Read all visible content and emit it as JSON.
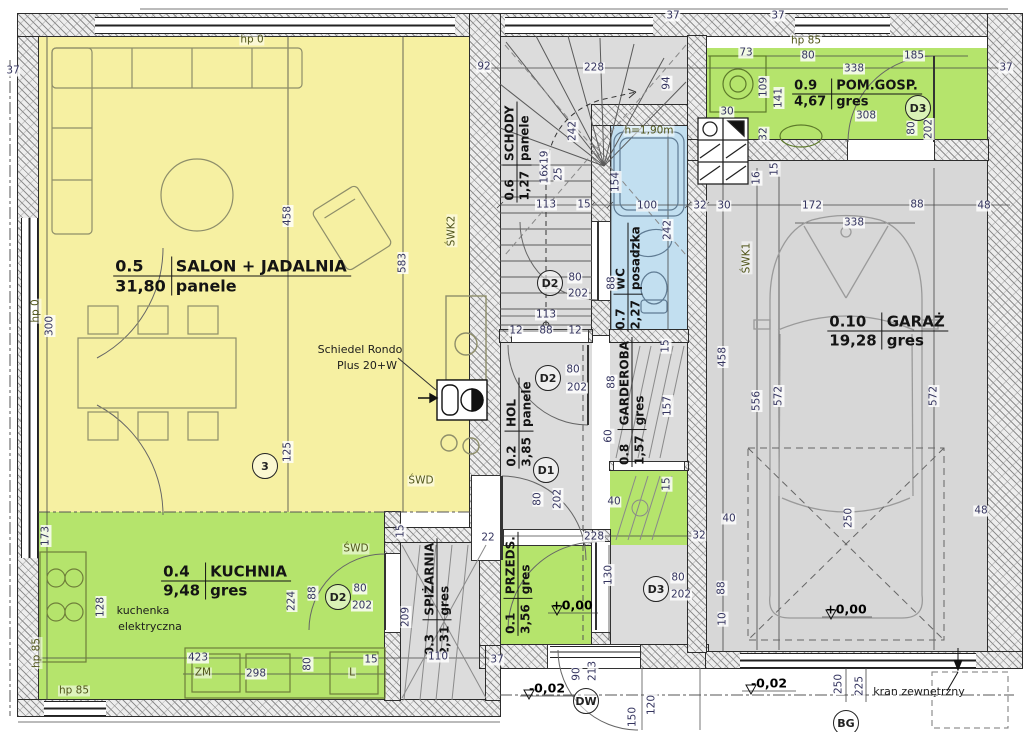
{
  "plan": {
    "rooms": [
      {
        "id": "0.1",
        "name": "PRZEDS.",
        "area": "3,56",
        "floor": "gres"
      },
      {
        "id": "0.2",
        "name": "HOL",
        "area": "3,85",
        "floor": "panele"
      },
      {
        "id": "0.3",
        "name": "SPIŻARNIA",
        "area": "2,31",
        "floor": "gres"
      },
      {
        "id": "0.4",
        "name": "KUCHNIA",
        "area": "9,48",
        "floor": "gres"
      },
      {
        "id": "0.5",
        "name": "SALON + JADALNIA",
        "area": "31,80",
        "floor": "panele"
      },
      {
        "id": "0.6",
        "name": "SCHODY",
        "area": "1,27",
        "floor": "panele"
      },
      {
        "id": "0.7",
        "name": "WC",
        "area": "2,27",
        "floor": "posadzka"
      },
      {
        "id": "0.8",
        "name": "GARDEROBA",
        "area": "1,57",
        "floor": "gres"
      },
      {
        "id": "0.9",
        "name": "POM.GOSP.",
        "area": "4,67",
        "floor": "gres"
      },
      {
        "id": "0.10",
        "name": "GARAŻ",
        "area": "19,28",
        "floor": "gres"
      }
    ],
    "colors": {
      "salon": "#f6f0a2",
      "kitchen": "#b5e46c",
      "wc": "#c2dff0",
      "gray": "#dcdcdc",
      "garage": "#d7d7d7"
    },
    "door_tags": [
      {
        "t": "D2",
        "x": 338,
        "y": 597
      },
      {
        "t": "D2",
        "x": 550,
        "y": 283
      },
      {
        "t": "D2",
        "x": 548,
        "y": 378
      },
      {
        "t": "D1",
        "x": 546,
        "y": 470
      },
      {
        "t": "D3",
        "x": 656,
        "y": 589
      },
      {
        "t": "D3",
        "x": 918,
        "y": 108
      },
      {
        "t": "DW",
        "x": 586,
        "y": 701
      },
      {
        "t": "BG",
        "x": 846,
        "y": 723
      },
      {
        "t": "3",
        "x": 265,
        "y": 466
      }
    ],
    "labels": [
      {
        "t": "37",
        "x": 13,
        "y": 71
      },
      {
        "t": "hp 0",
        "x": 252,
        "y": 40,
        "k": "ann"
      },
      {
        "t": "92",
        "x": 484,
        "y": 67
      },
      {
        "t": "228",
        "x": 594,
        "y": 68
      },
      {
        "t": "94",
        "x": 667,
        "y": 83,
        "r": 1
      },
      {
        "t": "37",
        "x": 673,
        "y": 16
      },
      {
        "t": "37",
        "x": 778,
        "y": 16
      },
      {
        "t": "73",
        "x": 746,
        "y": 53
      },
      {
        "t": "hp 85",
        "x": 806,
        "y": 41,
        "k": "ann"
      },
      {
        "t": "80",
        "x": 808,
        "y": 56
      },
      {
        "t": "185",
        "x": 914,
        "y": 56
      },
      {
        "t": "338",
        "x": 854,
        "y": 69
      },
      {
        "t": "109",
        "x": 764,
        "y": 87,
        "r": 1
      },
      {
        "t": "141",
        "x": 779,
        "y": 98,
        "r": 1
      },
      {
        "t": "308",
        "x": 866,
        "y": 116
      },
      {
        "t": "30",
        "x": 727,
        "y": 112
      },
      {
        "t": "32",
        "x": 764,
        "y": 134,
        "r": 1
      },
      {
        "t": "37",
        "x": 1006,
        "y": 68
      },
      {
        "t": "80",
        "x": 912,
        "y": 128,
        "r": 1
      },
      {
        "t": "202",
        "x": 929,
        "y": 129,
        "r": 1
      },
      {
        "t": "h=1,90m",
        "x": 649,
        "y": 131,
        "k": "ann"
      },
      {
        "t": "113",
        "x": 546,
        "y": 205
      },
      {
        "t": "15",
        "x": 584,
        "y": 205
      },
      {
        "t": "100",
        "x": 647,
        "y": 206
      },
      {
        "t": "32",
        "x": 700,
        "y": 206
      },
      {
        "t": "30",
        "x": 724,
        "y": 206
      },
      {
        "t": "172",
        "x": 812,
        "y": 206
      },
      {
        "t": "88",
        "x": 917,
        "y": 205
      },
      {
        "t": "48",
        "x": 984,
        "y": 206
      },
      {
        "t": "338",
        "x": 854,
        "y": 223
      },
      {
        "t": "16",
        "x": 757,
        "y": 178,
        "r": 1
      },
      {
        "t": "15",
        "x": 775,
        "y": 169,
        "r": 1
      },
      {
        "t": "ŚWK1",
        "x": 747,
        "y": 258,
        "r": 1,
        "k": "ann"
      },
      {
        "t": "242",
        "x": 668,
        "y": 230,
        "r": 1
      },
      {
        "t": "154",
        "x": 616,
        "y": 182,
        "r": 1
      },
      {
        "t": "88",
        "x": 612,
        "y": 283,
        "r": 1
      },
      {
        "t": "16x19",
        "x": 545,
        "y": 167,
        "r": 1
      },
      {
        "t": "25",
        "x": 559,
        "y": 174,
        "r": 1
      },
      {
        "t": "242",
        "x": 573,
        "y": 131,
        "r": 1
      },
      {
        "t": "583",
        "x": 403,
        "y": 263,
        "r": 1
      },
      {
        "t": "458",
        "x": 288,
        "y": 216,
        "r": 1
      },
      {
        "t": "125",
        "x": 288,
        "y": 452,
        "r": 1
      },
      {
        "t": "hp 0",
        "x": 36,
        "y": 311,
        "r": 1,
        "k": "ann"
      },
      {
        "t": "300",
        "x": 50,
        "y": 326,
        "r": 1
      },
      {
        "t": "173",
        "x": 46,
        "y": 536,
        "r": 1
      },
      {
        "t": "128",
        "x": 101,
        "y": 607,
        "r": 1
      },
      {
        "t": "ŚWK2",
        "x": 452,
        "y": 231,
        "r": 1,
        "k": "ann"
      },
      {
        "t": "ŚWD",
        "x": 421,
        "y": 481,
        "k": "ann"
      },
      {
        "t": "ŚWD",
        "x": 356,
        "y": 549,
        "k": "ann"
      },
      {
        "t": "Schiedel Rondo",
        "x": 360,
        "y": 350,
        "k": "note"
      },
      {
        "t": "Plus 20+W",
        "x": 367,
        "y": 366,
        "k": "note"
      },
      {
        "t": "kuchenka",
        "x": 143,
        "y": 611,
        "k": "note"
      },
      {
        "t": "elektryczna",
        "x": 150,
        "y": 627,
        "k": "note"
      },
      {
        "t": "224",
        "x": 292,
        "y": 601,
        "r": 1
      },
      {
        "t": "88",
        "x": 313,
        "y": 593,
        "r": 1
      },
      {
        "t": "80",
        "x": 360,
        "y": 589
      },
      {
        "t": "202",
        "x": 362,
        "y": 606
      },
      {
        "t": "209",
        "x": 406,
        "y": 617,
        "r": 1
      },
      {
        "t": "15",
        "x": 401,
        "y": 531,
        "r": 1
      },
      {
        "t": "22",
        "x": 488,
        "y": 538
      },
      {
        "t": "110",
        "x": 438,
        "y": 657
      },
      {
        "t": "37",
        "x": 497,
        "y": 660
      },
      {
        "t": "423",
        "x": 198,
        "y": 658
      },
      {
        "t": "ZM",
        "x": 203,
        "y": 673,
        "k": "ann"
      },
      {
        "t": "298",
        "x": 256,
        "y": 674
      },
      {
        "t": "80",
        "x": 308,
        "y": 664,
        "r": 1
      },
      {
        "t": "L",
        "x": 352,
        "y": 673,
        "k": "ann"
      },
      {
        "t": "15",
        "x": 371,
        "y": 660
      },
      {
        "t": "hp 85",
        "x": 74,
        "y": 691,
        "k": "ann"
      },
      {
        "t": "hp 85",
        "x": 37,
        "y": 653,
        "r": 1,
        "k": "ann"
      },
      {
        "t": "12",
        "x": 516,
        "y": 331
      },
      {
        "t": "88",
        "x": 546,
        "y": 331
      },
      {
        "t": "12",
        "x": 575,
        "y": 331
      },
      {
        "t": "113",
        "x": 546,
        "y": 315
      },
      {
        "t": "80",
        "x": 575,
        "y": 278
      },
      {
        "t": "202",
        "x": 578,
        "y": 294
      },
      {
        "t": "80",
        "x": 573,
        "y": 370
      },
      {
        "t": "202",
        "x": 577,
        "y": 388
      },
      {
        "t": "80",
        "x": 538,
        "y": 499,
        "r": 1
      },
      {
        "t": "202",
        "x": 558,
        "y": 499,
        "r": 1
      },
      {
        "t": "60",
        "x": 609,
        "y": 436,
        "r": 1
      },
      {
        "t": "88",
        "x": 612,
        "y": 382,
        "r": 1
      },
      {
        "t": "15",
        "x": 666,
        "y": 346,
        "r": 1
      },
      {
        "t": "157",
        "x": 668,
        "y": 406,
        "r": 1
      },
      {
        "t": "458",
        "x": 723,
        "y": 357,
        "r": 1
      },
      {
        "t": "15",
        "x": 667,
        "y": 484,
        "r": 1
      },
      {
        "t": "40",
        "x": 614,
        "y": 502
      },
      {
        "t": "40",
        "x": 729,
        "y": 519
      },
      {
        "t": "32",
        "x": 699,
        "y": 536
      },
      {
        "t": "228",
        "x": 594,
        "y": 537
      },
      {
        "t": "+0,00",
        "x": 572,
        "y": 605,
        "k": "lvl"
      },
      {
        "t": "130",
        "x": 609,
        "y": 575,
        "r": 1
      },
      {
        "t": "80",
        "x": 678,
        "y": 578
      },
      {
        "t": "202",
        "x": 681,
        "y": 595
      },
      {
        "t": "88",
        "x": 722,
        "y": 588,
        "r": 1
      },
      {
        "t": "10",
        "x": 723,
        "y": 619,
        "r": 1
      },
      {
        "t": "-0,02",
        "x": 547,
        "y": 688,
        "k": "lvl"
      },
      {
        "t": "90",
        "x": 577,
        "y": 674,
        "r": 1
      },
      {
        "t": "213",
        "x": 593,
        "y": 671,
        "r": 1
      },
      {
        "t": "150",
        "x": 633,
        "y": 717,
        "r": 1
      },
      {
        "t": "120",
        "x": 652,
        "y": 705,
        "r": 1
      },
      {
        "t": "556",
        "x": 757,
        "y": 401,
        "r": 1
      },
      {
        "t": "572",
        "x": 779,
        "y": 396,
        "r": 1
      },
      {
        "t": "572",
        "x": 934,
        "y": 396,
        "r": 1
      },
      {
        "t": "+0,00",
        "x": 846,
        "y": 609,
        "k": "lvl"
      },
      {
        "t": "250",
        "x": 849,
        "y": 518,
        "r": 1
      },
      {
        "t": "48",
        "x": 981,
        "y": 511
      },
      {
        "t": "-0,02",
        "x": 769,
        "y": 683,
        "k": "lvl"
      },
      {
        "t": "250",
        "x": 839,
        "y": 684,
        "r": 1
      },
      {
        "t": "225",
        "x": 860,
        "y": 686,
        "r": 1
      },
      {
        "t": "kran zewnętrzny",
        "x": 919,
        "y": 692,
        "k": "note"
      }
    ]
  }
}
